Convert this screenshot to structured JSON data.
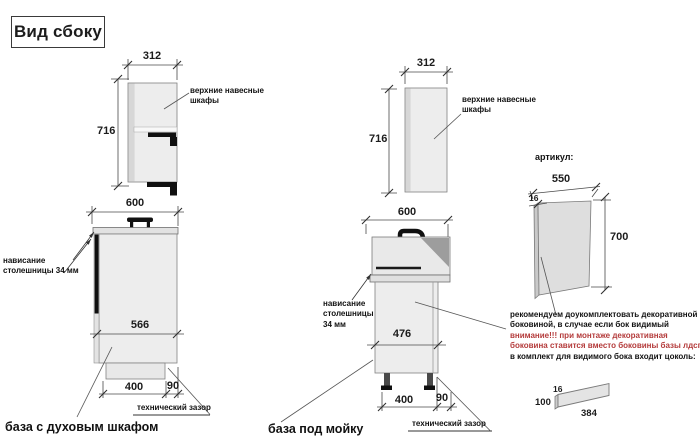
{
  "title": "Вид сбоку",
  "colors": {
    "warning_red": "#b43b3b",
    "cabinet_fill": "#ededed",
    "cabinet_border": "#828282",
    "accent_black": "#101010"
  },
  "left": {
    "upper": {
      "width": "312",
      "height": "716",
      "label": "верхние навесные шкафы"
    },
    "base": {
      "width": "600",
      "inner_depth": "566",
      "plinth_width": "400",
      "gap": "90",
      "overhang_label": "нависание столешницы 34 мм",
      "gap_label": "технический зазор",
      "caption": "база с духовым шкафом"
    }
  },
  "middle": {
    "upper": {
      "width": "312",
      "height": "716",
      "label": "верхние навесные шкафы"
    },
    "base": {
      "width": "600",
      "inner_depth": "476",
      "plinth_width": "400",
      "gap": "90",
      "overhang_label": "нависание столешницы 34 мм",
      "gap_label": "технический зазор",
      "caption": "база под мойку"
    }
  },
  "right": {
    "articul": "артикул:",
    "side_panel": {
      "width": "550",
      "thickness": "16",
      "height": "700"
    },
    "note": {
      "line1": "рекомендуем доукомплектовать декоративной",
      "line2": "боковиной, в случае если бок видимый",
      "line3": "внимание!!! при монтаже декоративная",
      "line4": "боковина ставится вместо боковины базы лдсп",
      "line5": "в комплект для видимого бока входит цоколь:"
    },
    "plinth": {
      "thickness": "16",
      "height": "100",
      "length": "384"
    }
  }
}
